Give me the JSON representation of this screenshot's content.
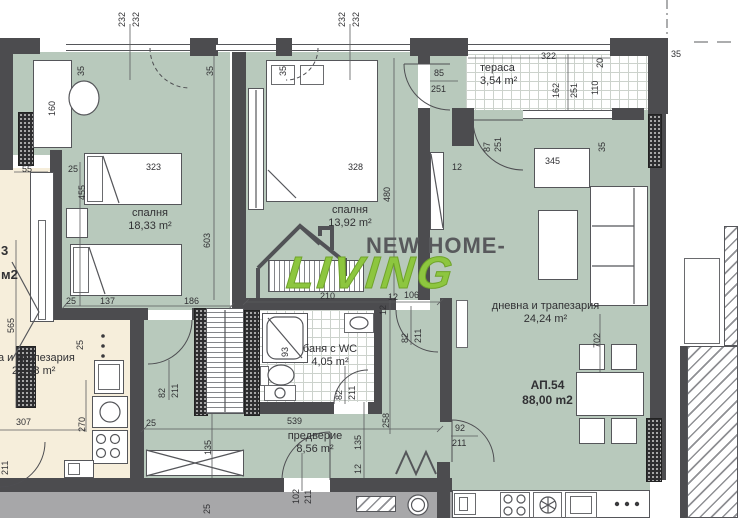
{
  "plan": {
    "apartment": {
      "number": "АП.54",
      "area": "88,00 m2"
    },
    "rooms": {
      "bedroom1": {
        "name": "спалня",
        "area": "18,33 m²"
      },
      "bedroom2": {
        "name": "спалня",
        "area": "13,92 m²"
      },
      "living": {
        "name": "дневна и трапезария",
        "area": "24,24 m²"
      },
      "bathroom": {
        "name": "баня с WC",
        "area": "4,05 m²"
      },
      "hall": {
        "name": "предверие",
        "area": "8,56 m²"
      },
      "terrace": {
        "name": "тераса",
        "area": "3,54 m²"
      },
      "neighbor": {
        "name": "а и трапезария",
        "area": "21,98 m²",
        "fragment_number": "3",
        "fragment_unit": "м2"
      }
    },
    "watermark": {
      "line1": "NEW HOME-",
      "line2": "LIVING",
      "color": "#8dc63f"
    },
    "colors": {
      "room_fill": "#b8c9bc",
      "neighbor_fill": "#f6eedb",
      "wall": "#4c4c4f",
      "corridor": "#a7a7a9"
    },
    "dims": [
      {
        "t": "232",
        "x": 117,
        "y": 27,
        "r": 1
      },
      {
        "t": "232",
        "x": 131,
        "y": 27,
        "r": 1
      },
      {
        "t": "232",
        "x": 337,
        "y": 27,
        "r": 1
      },
      {
        "t": "232",
        "x": 351,
        "y": 27,
        "r": 1
      },
      {
        "t": "35",
        "x": 76,
        "y": 76,
        "r": 1
      },
      {
        "t": "35",
        "x": 205,
        "y": 76,
        "r": 1
      },
      {
        "t": "35",
        "x": 278,
        "y": 76,
        "r": 1
      },
      {
        "t": "35",
        "x": 671,
        "y": 49
      },
      {
        "t": "85",
        "x": 434,
        "y": 68
      },
      {
        "t": "251",
        "x": 431,
        "y": 84
      },
      {
        "t": "322",
        "x": 541,
        "y": 51
      },
      {
        "t": "20",
        "x": 595,
        "y": 68,
        "r": 1
      },
      {
        "t": "162",
        "x": 551,
        "y": 98,
        "r": 1
      },
      {
        "t": "251",
        "x": 569,
        "y": 98,
        "r": 1
      },
      {
        "t": "110",
        "x": 590,
        "y": 95,
        "r": 1
      },
      {
        "t": "87",
        "x": 482,
        "y": 152,
        "r": 1
      },
      {
        "t": "251",
        "x": 493,
        "y": 152,
        "r": 1
      },
      {
        "t": "35",
        "x": 597,
        "y": 152,
        "r": 1
      },
      {
        "t": "12",
        "x": 452,
        "y": 162
      },
      {
        "t": "345",
        "x": 545,
        "y": 156
      },
      {
        "t": "55",
        "x": 22,
        "y": 164
      },
      {
        "t": "160",
        "x": 47,
        "y": 116,
        "r": 1
      },
      {
        "t": "25",
        "x": 68,
        "y": 164
      },
      {
        "t": "455",
        "x": 77,
        "y": 200,
        "r": 1
      },
      {
        "t": "323",
        "x": 146,
        "y": 162
      },
      {
        "t": "328",
        "x": 348,
        "y": 162
      },
      {
        "t": "480",
        "x": 382,
        "y": 202,
        "r": 1
      },
      {
        "t": "603",
        "x": 202,
        "y": 248,
        "r": 1
      },
      {
        "t": "565",
        "x": 6,
        "y": 333,
        "r": 1
      },
      {
        "t": "25",
        "x": 66,
        "y": 296
      },
      {
        "t": "137",
        "x": 100,
        "y": 296
      },
      {
        "t": "186",
        "x": 184,
        "y": 296
      },
      {
        "t": "210",
        "x": 320,
        "y": 291
      },
      {
        "t": "12",
        "x": 388,
        "y": 292
      },
      {
        "t": "106",
        "x": 404,
        "y": 290
      },
      {
        "t": "82",
        "x": 157,
        "y": 398,
        "r": 1
      },
      {
        "t": "211",
        "x": 170,
        "y": 398,
        "r": 1
      },
      {
        "t": "12",
        "x": 378,
        "y": 315,
        "r": 1
      },
      {
        "t": "82",
        "x": 400,
        "y": 343,
        "r": 1
      },
      {
        "t": "211",
        "x": 413,
        "y": 343,
        "r": 1
      },
      {
        "t": "93",
        "x": 280,
        "y": 357,
        "r": 1
      },
      {
        "t": "82",
        "x": 334,
        "y": 400,
        "r": 1
      },
      {
        "t": "211",
        "x": 347,
        "y": 400,
        "r": 1
      },
      {
        "t": "539",
        "x": 287,
        "y": 416
      },
      {
        "t": "25",
        "x": 146,
        "y": 418
      },
      {
        "t": "258",
        "x": 381,
        "y": 428,
        "r": 1
      },
      {
        "t": "135",
        "x": 353,
        "y": 450,
        "r": 1
      },
      {
        "t": "12",
        "x": 353,
        "y": 474,
        "r": 1
      },
      {
        "t": "135",
        "x": 203,
        "y": 455,
        "r": 1
      },
      {
        "t": "102",
        "x": 291,
        "y": 504,
        "r": 1
      },
      {
        "t": "211",
        "x": 303,
        "y": 504,
        "r": 1
      },
      {
        "t": "92",
        "x": 455,
        "y": 423
      },
      {
        "t": "211",
        "x": 452,
        "y": 438
      },
      {
        "t": "702",
        "x": 592,
        "y": 348,
        "r": 1
      },
      {
        "t": "25",
        "x": 202,
        "y": 514,
        "r": 1
      },
      {
        "t": "307",
        "x": 16,
        "y": 417
      },
      {
        "t": "270",
        "x": 77,
        "y": 432,
        "r": 1
      },
      {
        "t": "211",
        "x": 0,
        "y": 475,
        "r": 1
      },
      {
        "t": "25",
        "x": 75,
        "y": 350,
        "r": 1
      },
      {
        "t": "3",
        "x": 1,
        "y": 246,
        "b": 1
      },
      {
        "t": "м2",
        "x": 1,
        "y": 270,
        "b": 1
      }
    ]
  }
}
